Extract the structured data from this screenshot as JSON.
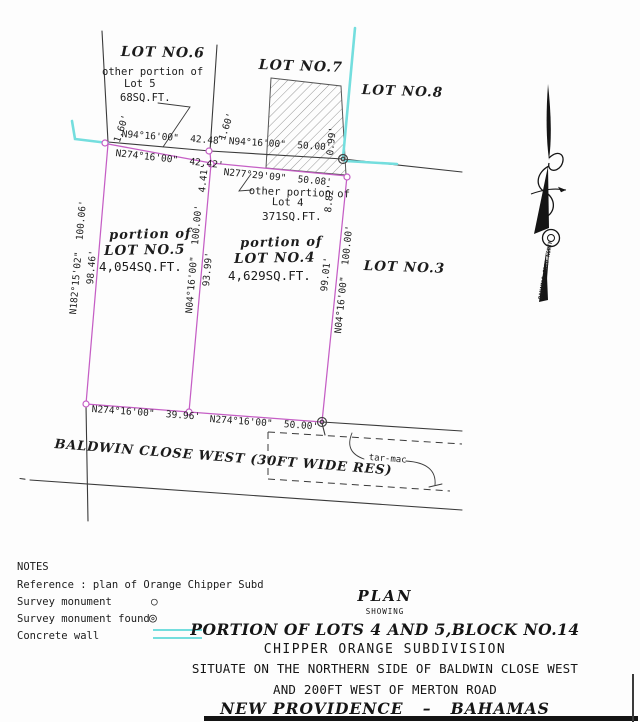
{
  "colors": {
    "boundary": "#c55ec5",
    "wall": "#74dede",
    "ink": "#3a3a3a"
  },
  "lots": {
    "lot6": "LOT NO.6",
    "lot7": "LOT NO.7",
    "lot8": "LOT NO.8",
    "lot3": "LOT NO.3",
    "lot5": {
      "l1": "portion of",
      "l2": "LOT NO.5",
      "area": "4,054SQ.FT."
    },
    "lot4": {
      "l1": "portion of",
      "l2": "LOT NO.4",
      "area": "4,629SQ.FT."
    },
    "other5": {
      "l1": "other portion of",
      "l2": "Lot 5",
      "area": "68SQ.FT."
    },
    "other4": {
      "l1": "other portion of",
      "l2": "Lot 4",
      "area": "371SQ.FT."
    }
  },
  "bearings": {
    "top_n94_4248": "N94°16'00\"  42.48'",
    "top_n274_4242": "N274°16'00\"  42.42'",
    "top_n94_5000": "N94°16'00\"  50.00'",
    "top_n277_5008": "N277°29'09\"  50.08'",
    "left_n182": "N182°15'02\"  100.06'",
    "left_9846": "98.46'",
    "mid_n04": "N04°16'00\"  100.00'",
    "mid_9399": "93.99'",
    "right_9901": "99.01'",
    "right_n04": "N04°16'00\"  100.00'",
    "bot_3996": "N274°16'00\"  39.96'",
    "bot_5000": "N274°16'00\"  50.00'",
    "off_160_left": "1.60'",
    "off_160_right": "1.60'",
    "off_099": "0.99'",
    "off_441": "4.41'",
    "off_882": "8.82'"
  },
  "road": {
    "name": "BALDWIN CLOSE WEST (30FT WIDE RES)",
    "surface_label": "tar-mac"
  },
  "north_arrow": {
    "label": "BAHAMAS GRID NORTH"
  },
  "notes": {
    "title": "NOTES",
    "reference": "Reference : plan of Orange Chipper Subd",
    "survey_monument": "Survey monument",
    "survey_monument_found": "Survey monument found",
    "concrete_wall": "Concrete wall"
  },
  "legend": {
    "monument_symbol": "○",
    "monument_found_symbol": "◎"
  },
  "title_block": {
    "plan": "PLAN",
    "showing": "SHOWING",
    "line1": "PORTION OF LOTS 4 AND 5,BLOCK NO.14",
    "line2": "CHIPPER ORANGE SUBDIVISION",
    "line3": "SITUATE ON THE NORTHERN SIDE OF BALDWIN CLOSE WEST",
    "line4": "AND 200FT WEST OF MERTON ROAD",
    "line5": "NEW PROVIDENCE   –   BAHAMAS"
  }
}
